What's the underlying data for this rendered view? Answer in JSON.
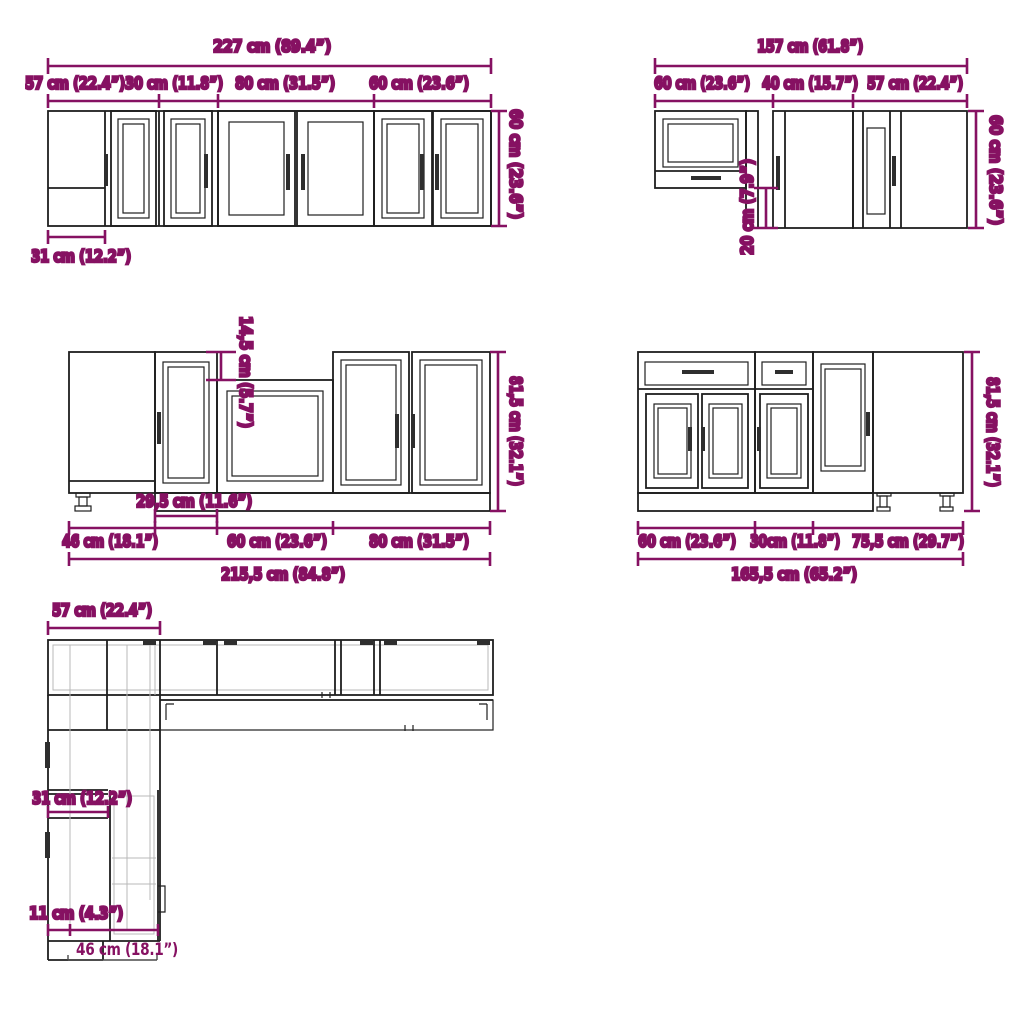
{
  "title": "Kitchen cabinet set dimension diagram",
  "colors": {
    "dimension_accent": "#861162",
    "line_art": "#1f1f1f",
    "background": "#ffffff"
  },
  "wall_run_left": {
    "total": "227 cm (89.4”)",
    "segments": [
      "57 cm (22.4”)",
      "30 cm (11.8”)",
      "80 cm (31.5”)",
      "60 cm (23.6”)"
    ],
    "height": "60 cm (23.6”)",
    "depth": "31 cm (12.2”)"
  },
  "wall_run_right": {
    "total": "157 cm (61.8”)",
    "segments": [
      "60 cm (23.6”)",
      "40 cm (15.7”)",
      "57 cm (22.4”)"
    ],
    "height": "60 cm (23.6”)",
    "drop": "20 cm (7.9”)"
  },
  "base_run_left": {
    "total": "215,5 cm (84.8”)",
    "segments": [
      "46 cm (18.1”)",
      "60 cm (23.6”)",
      "80 cm (31.5”)"
    ],
    "filler_width": "29,5 cm (11.6”)",
    "height": "81,5 cm (32.1”)",
    "recess": "14,5 cm (5.7”)"
  },
  "base_run_right": {
    "total": "165,5 cm (65.2”)",
    "segments": [
      "60 cm (23.6”)",
      "30cm (11.8”)",
      "75,5 cm (29.7”)"
    ],
    "height": "81,5 cm (32.1”)"
  },
  "floor_plan": {
    "corner_width": "57 cm (22.4”)",
    "wall_depth": "31 cm (12.2”)",
    "offset": "11 cm (4.3”)",
    "base_depth": "46 cm (18.1”)"
  }
}
